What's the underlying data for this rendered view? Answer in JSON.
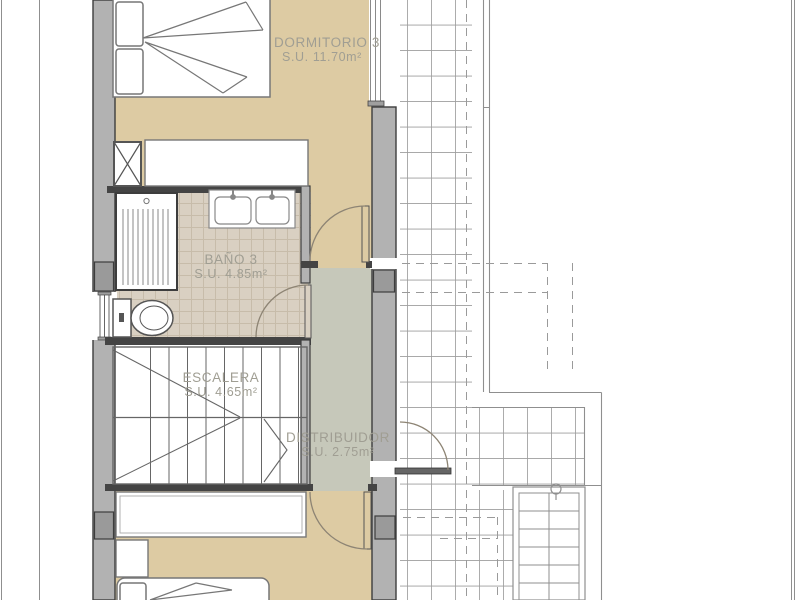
{
  "plan": {
    "type": "architectural-floor-plan",
    "rooms": [
      {
        "id": "dormitorio-3",
        "name": "DORMITORIO 3",
        "area": "S.U. 11.70m²"
      },
      {
        "id": "bano-3",
        "name": "BAÑO 3",
        "area": "S.U. 4.85m²"
      },
      {
        "id": "escalera",
        "name": "ESCALERA",
        "area": "S.U. 4.65m²"
      },
      {
        "id": "distribuidor",
        "name": "DISTRIBUIDOR",
        "area": "S.U. 2.75m²"
      }
    ],
    "colors": {
      "floor_bedroom": "#ddcba3",
      "floor_bathroom": "#d9d0c2",
      "floor_hall": "#c6c8ba",
      "wall_light": "#b2b2b2",
      "wall_pier": "#9a9a9a",
      "wall_dark": "#444444",
      "label_text": "#a09e93",
      "bath_tile_line": "#c7bcaa",
      "terrace_tile_line": "#9d9d9d",
      "door_arc": "#8d8474"
    }
  }
}
